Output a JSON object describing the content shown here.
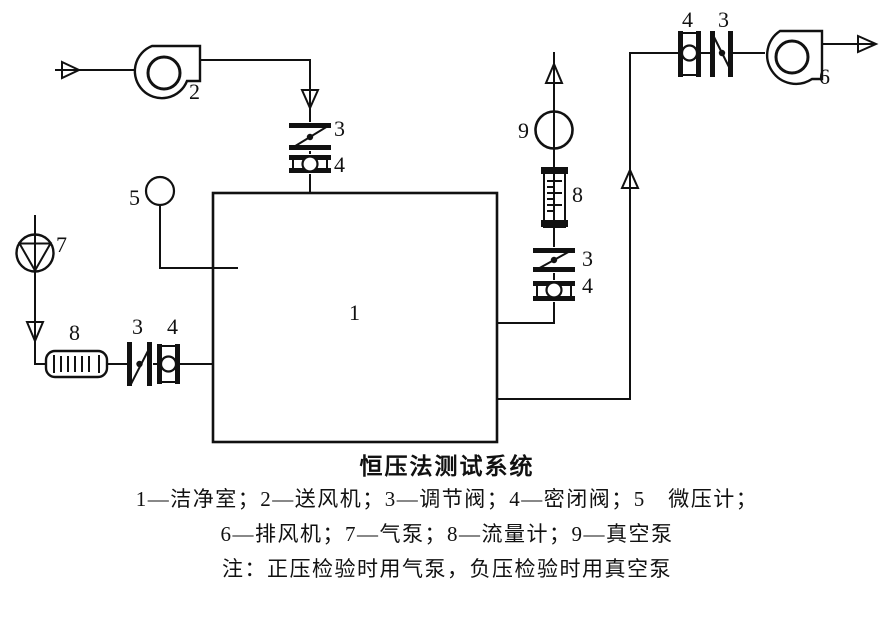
{
  "caption": {
    "title": "恒压法测试系统",
    "legend_line_1": "1—洁净室；2—送风机；3—调节阀；4—密闭阀；5　微压计；",
    "legend_line_2": "6—排风机；7—气泵；8—流量计；9—真空泵",
    "note": "注：正压检验时用气泵，负压检验时用真空泵"
  },
  "labels": {
    "cleanroom": "1",
    "supply_fan": "2",
    "regulating_valve": "3",
    "sealed_valve": "4",
    "micro_manometer": "5",
    "exhaust_fan": "6",
    "air_pump": "7",
    "flow_meter": "8",
    "vacuum_pump": "9"
  },
  "colors": {
    "ink": "#111111",
    "paper": "#ffffff"
  }
}
